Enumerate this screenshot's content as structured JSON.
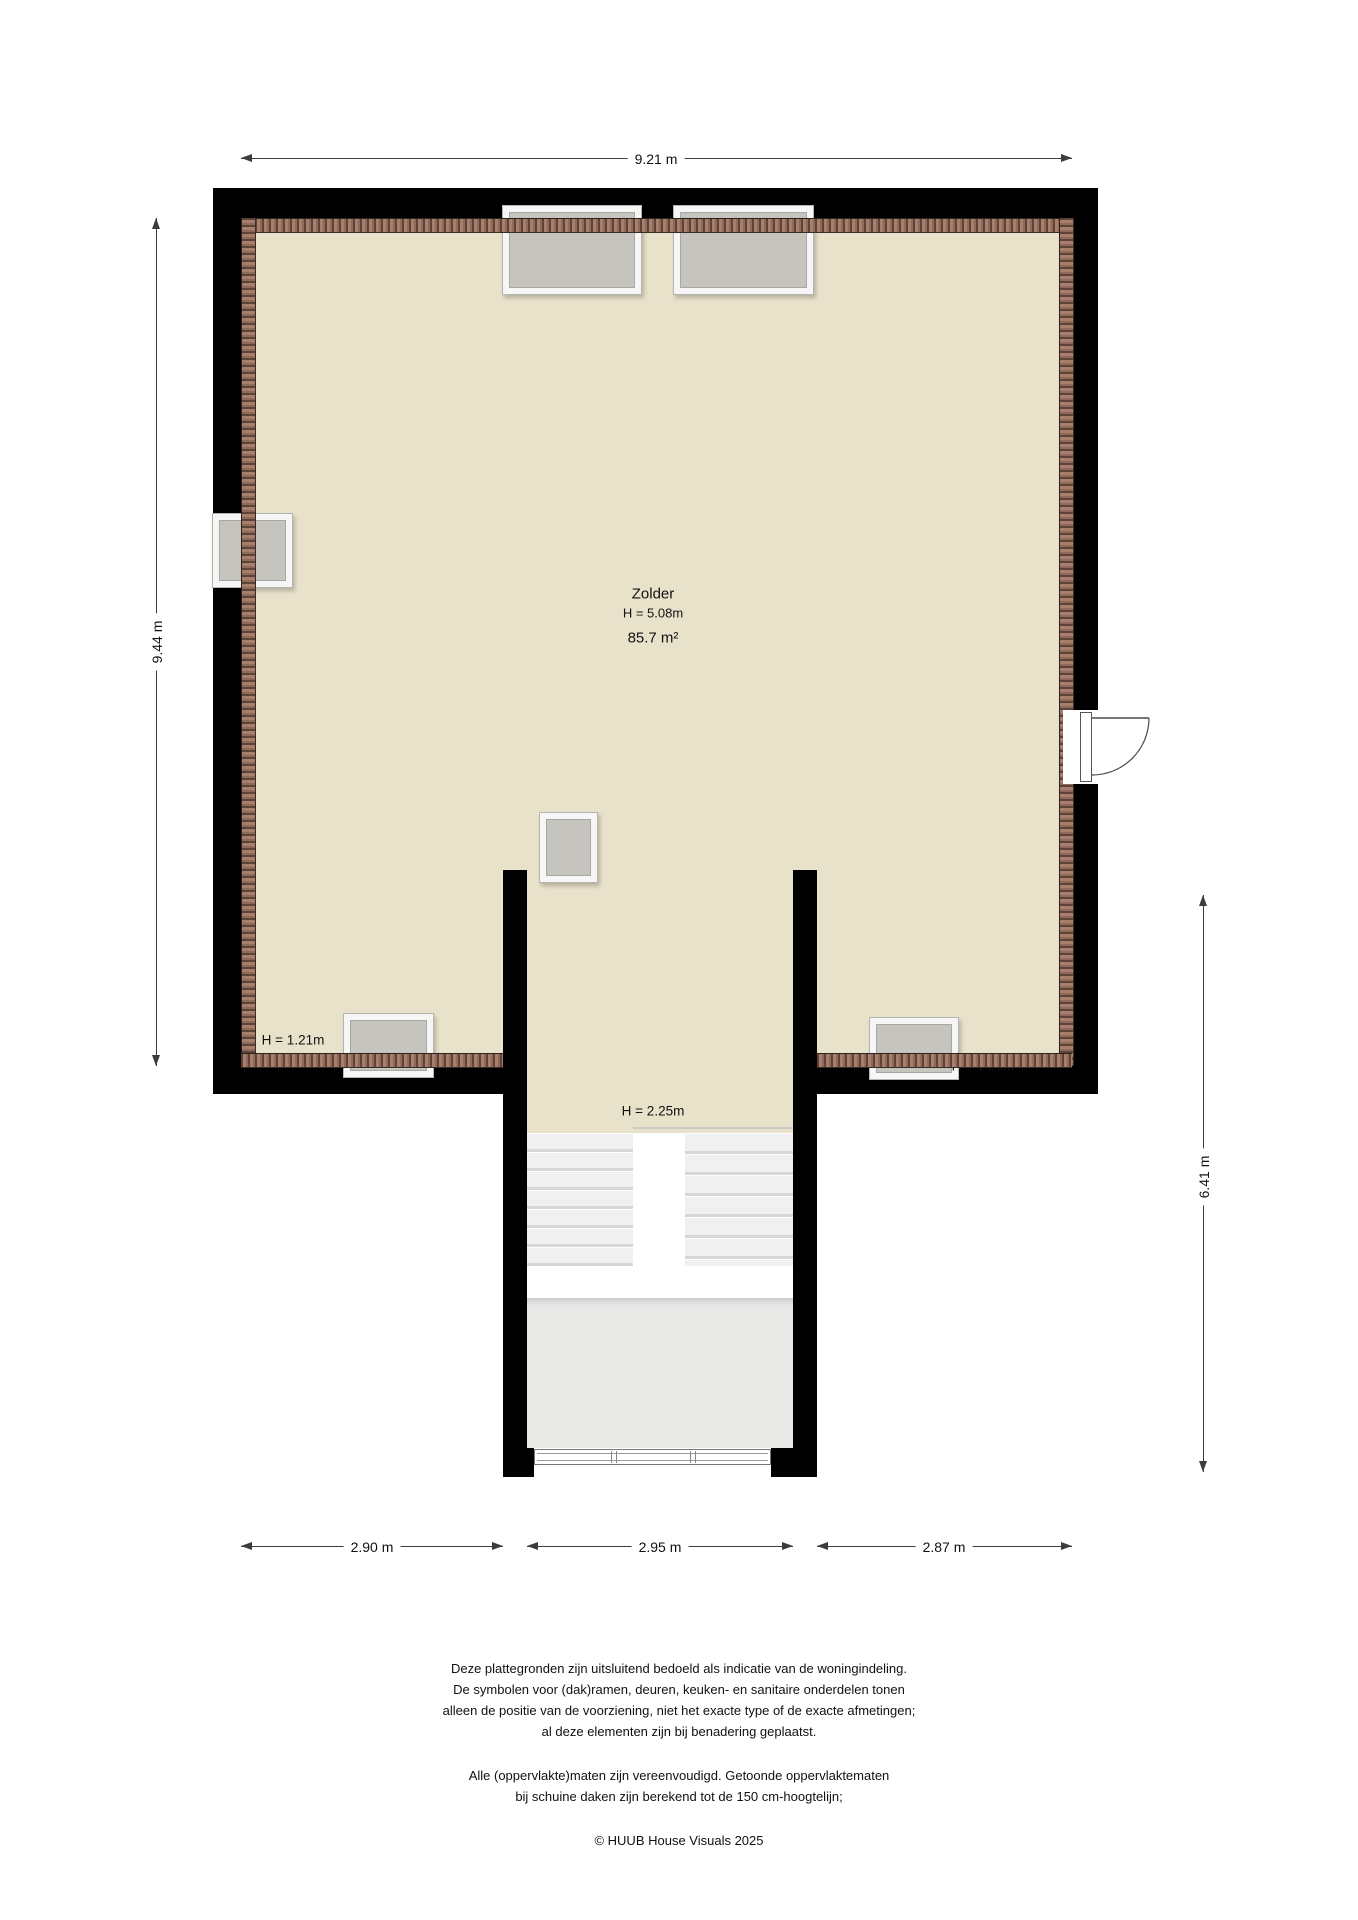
{
  "plan": {
    "room": {
      "name": "Zolder",
      "ceiling_height": "H = 5.08m",
      "area": "85.7 m²"
    },
    "height_labels": {
      "bottom_left": "H = 1.21m",
      "stairwell": "H = 2.25m",
      "bottom_right": "H = 1.23m"
    },
    "dimensions": {
      "top": "9.21 m",
      "left": "9.44 m",
      "right": "6.41 m",
      "bottom": [
        "2.90 m",
        "2.95 m",
        "2.87 m"
      ]
    },
    "features": {
      "skylights": 6,
      "door": "right-wall-outswing",
      "stairs": "double-flight-with-landing"
    },
    "colors": {
      "floor": "#e9e2cb",
      "wall": "#000000",
      "roof_tiles": "#9b6f5c",
      "window_pane": "#c6c4bf",
      "window_frame": "#f6f6f6",
      "stairs": "#f0f0f0",
      "landing": "#e9e9e8",
      "dimension_line": "#3c3c3c"
    }
  },
  "footer": {
    "disclaimer1": [
      "Deze plattegronden zijn uitsluitend bedoeld als indicatie van de woningindeling.",
      "De symbolen voor (dak)ramen, deuren, keuken- en sanitaire onderdelen tonen",
      "alleen de positie van de voorziening, niet het exacte type of de exacte afmetingen;",
      "al deze elementen zijn bij benadering geplaatst."
    ],
    "disclaimer2": [
      "Alle (oppervlakte)maten zijn vereenvoudigd. Getoonde oppervlaktematen",
      "bij schuine daken zijn berekend tot de 150 cm-hoogtelijn;"
    ],
    "copyright": "© HUUB House Visuals 2025"
  }
}
